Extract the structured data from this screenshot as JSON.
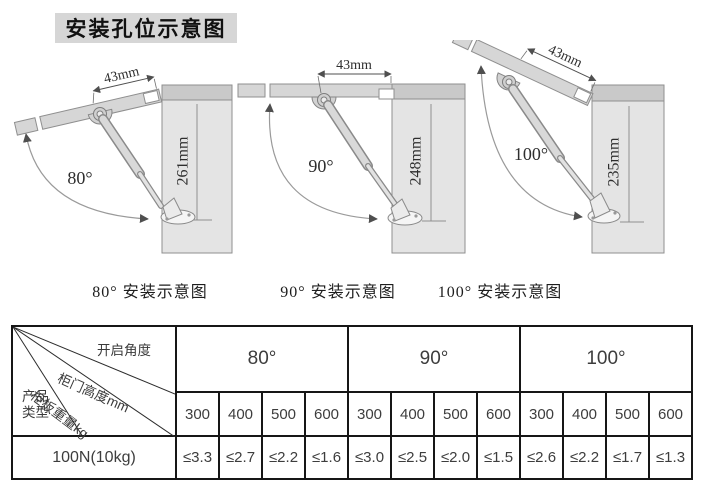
{
  "title": "安装孔位示意图",
  "diagrams": [
    {
      "width_label": "43mm",
      "angle_label": "80°",
      "height_label": "261mm",
      "caption": "80°  安装示意图"
    },
    {
      "width_label": "43mm",
      "angle_label": "90°",
      "height_label": "248mm",
      "caption": "90°  安装示意图"
    },
    {
      "width_label": "43mm",
      "angle_label": "100°",
      "height_label": "235mm",
      "caption": "100°  安装示意图"
    }
  ],
  "table": {
    "corner": {
      "open_angle": "开启角度",
      "door_height": "柜门高度mm",
      "board_weight": "柜板重量kg",
      "product_type_line1": "产品",
      "product_type_line2": "类型"
    },
    "angle_headers": [
      "80°",
      "90°",
      "100°"
    ],
    "height_headers": [
      "300",
      "400",
      "500",
      "600"
    ],
    "rows": [
      {
        "label": "100N(10kg)",
        "values": [
          "≤3.3",
          "≤2.7",
          "≤2.2",
          "≤1.6",
          "≤3.0",
          "≤2.5",
          "≤2.0",
          "≤1.5",
          "≤2.6",
          "≤2.2",
          "≤1.7",
          "≤1.3"
        ]
      }
    ]
  },
  "colors": {
    "panel": "#e4e4e4",
    "panel_top_band": "#c9c9c9",
    "door": "#d6d6d6",
    "outline": "#8f8f8f",
    "title_bg": "#d6d6d6",
    "table_border": "#161616"
  }
}
